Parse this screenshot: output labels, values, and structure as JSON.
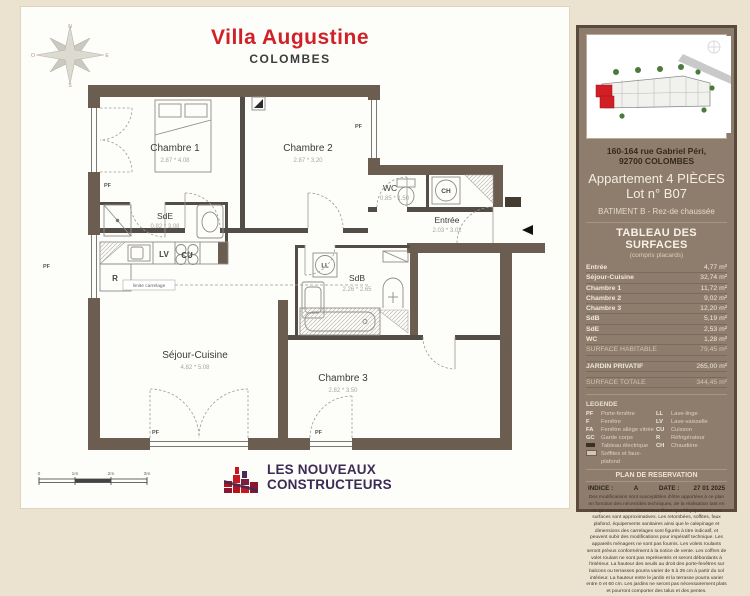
{
  "title": {
    "main": "Villa Augustine",
    "sub": "COLOMBES"
  },
  "plan": {
    "rooms": {
      "chambre1": {
        "name": "Chambre 1",
        "dims": "2.87 * 4.08"
      },
      "chambre2": {
        "name": "Chambre 2",
        "dims": "2.87 * 3.20"
      },
      "chambre3": {
        "name": "Chambre 3",
        "dims": "2.82 * 3.50"
      },
      "sejour": {
        "name": "Séjour-Cuisine",
        "dims": "4.82 * 5.08"
      },
      "entree": {
        "name": "Entrée",
        "dims": "2.03 * 3.02"
      },
      "wc": {
        "name": "WC",
        "dims": "0.85 * 1.50"
      },
      "sde": {
        "name": "SdE",
        "dims": "0.82 * 3.08"
      },
      "sdb": {
        "name": "SdB",
        "dims": "2.26 * 2.65"
      }
    },
    "tags": {
      "pf": "PF",
      "ch": "CH",
      "ll": "LL",
      "lv": "LV",
      "cu": "CU",
      "r": "R"
    },
    "limite": "limite carrelage",
    "scale": [
      "0",
      "1m",
      "2m",
      "3m"
    ],
    "compass": {
      "n": "N",
      "e": "E",
      "s": "S",
      "o": "O"
    }
  },
  "logo": {
    "line1": "LES NOUVEAUX",
    "line2": "CONSTRUCTEURS"
  },
  "sidebar": {
    "address_line1": "160-164 rue Gabriel Péri,",
    "address_line2": "92700 COLOMBES",
    "apartment_line1": "Appartement 4 PIÈCES",
    "apartment_line2": "Lot n° B07",
    "building": "BATIMENT B - Rez-de chaussée",
    "surfaces": {
      "title": "TABLEAU DES SURFACES",
      "subtitle": "(compris placards)",
      "rows": [
        {
          "label": "Entrée",
          "value": "4,77 m²"
        },
        {
          "label": "Séjour-Cuisine",
          "value": "32,74 m²"
        },
        {
          "label": "Chambre 1",
          "value": "11,72 m²"
        },
        {
          "label": "Chambre 2",
          "value": "9,02 m²"
        },
        {
          "label": "Chambre 3",
          "value": "12,20 m²"
        },
        {
          "label": "SdB",
          "value": "5,19 m²"
        },
        {
          "label": "SdE",
          "value": "2,53 m²"
        },
        {
          "label": "WC",
          "value": "1,28 m²"
        }
      ],
      "habitable": {
        "label": "SURFACE HABITABLE",
        "value": "79,45 m²"
      },
      "jardin": {
        "label": "JARDIN PRIVATIF",
        "value": "265,00 m²"
      },
      "totale": {
        "label": "SURFACE TOTALE",
        "value": "344,45 m²"
      }
    },
    "legend": {
      "title": "LEGENDE",
      "rows": [
        {
          "a1": "PF",
          "l1": "Porte-fenêtre",
          "a2": "LL",
          "l2": "Lave-linge"
        },
        {
          "a1": "F",
          "l1": "Fenêtre",
          "a2": "LV",
          "l2": "Lave-vaisselle"
        },
        {
          "a1": "FA",
          "l1": "Fenêtre allège vitrée",
          "a2": "CU",
          "l2": "Cuisson"
        },
        {
          "a1": "GC",
          "l1": "Garde corps",
          "a2": "R",
          "l2": "Réfrigérateur"
        },
        {
          "a1": "",
          "l1": "Tableau électrique",
          "a2": "CH",
          "l2": "Chaudière"
        },
        {
          "a1": "",
          "l1": "Soffites et faux-plafond",
          "a2": "",
          "l2": ""
        }
      ]
    },
    "reservation": {
      "title": "PLAN DE RESERVATION",
      "indice_label": "INDICE :",
      "indice_value": "A",
      "date_label": "DATE :",
      "date_value": "27 01 2025",
      "disclaimer": "Des modifications sont susceptibles d'être apportées à ce plan en fonction des nécessités techniques, de la réalisation tant en ce qui concerne les dimensions libres que l'équipement. Les surfaces sont approximatives. Les retombées, soffites, faux plafond, équipements sanitaires ainsi que le calepinage et dimensions des carrelages sont figurés à titre indicatif, et peuvent subir des modifications pour impératif technique. Les appareils ménagers ne sont pas fournis. Les volets roulants seront prévus conformément à la notice de vente. Les coffres de volet roulant ne sont pas représentés et seront débordants à l'intérieur. La hauteur des seuils au droit des porte-fenêtres sur balcons ou terrasses pourra varier de 5 à 35 cm à partir du sol intérieur. La hauteur entre le jardin et la terrasse pourra varier entre 0 et 60 cm. Les jardins ne seront pas nécessairement plats et pourront comporter des talus et des pentes."
    }
  }
}
